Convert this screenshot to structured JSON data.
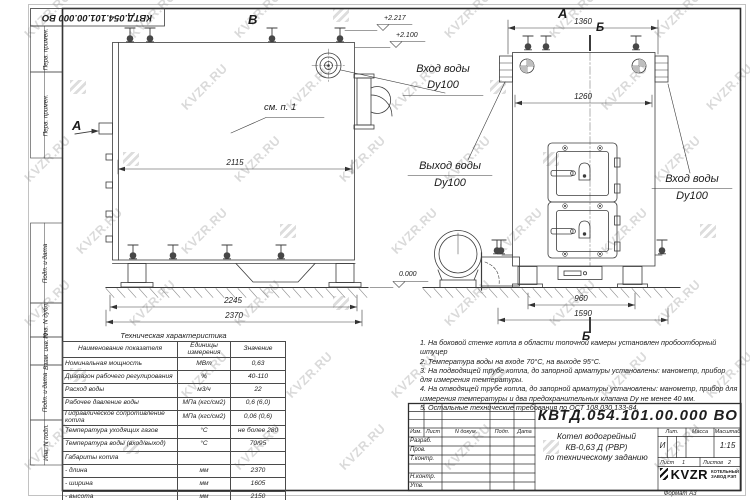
{
  "sheet": {
    "stamp_doc_number": "КВТД.054.101.00.000 ВО",
    "watermark_text": "KVZR.RU",
    "format_note": "Формат А3"
  },
  "margin_strips": [
    {
      "label": "Перв. примен."
    },
    {
      "label": "Перв. примен."
    },
    {
      "label": "Подп. и дата"
    },
    {
      "label": "Инв. N дубл."
    },
    {
      "label": "Взам. инв. N"
    },
    {
      "label": "Подп. и дата"
    },
    {
      "label": "Инв. N подл."
    }
  ],
  "views": {
    "left": {
      "view_label": "В",
      "direction_arrow_label": "А",
      "see_note_label": "см. п. 1",
      "elevation_top": "+2.217",
      "elevation_mid": "+2.100",
      "elevation_zero": "0.000",
      "dim_length_inner": "2115",
      "dim_length_mid": "2245",
      "dim_length_total": "2370",
      "inlet_line1": "Вход воды",
      "inlet_line2": "Dy100",
      "outlet_line1": "Выход воды",
      "outlet_line2": "Dy100"
    },
    "right": {
      "view_label": "А",
      "section_label_top": "Б",
      "section_label_bottom": "Б",
      "dim_width_top": "1360",
      "dim_width_inner": "1260",
      "dim_base_inner": "960",
      "dim_base_total": "1590",
      "inlet_line1": "Вход воды",
      "inlet_line2": "Dy100"
    }
  },
  "notes": [
    "1. На боковой стенке котла в области топочной камеры установлен пробоотборный штуцер",
    "2. Температура воды на входе 70°С, на выходе 95°С.",
    "3. На подводящей трубе котла, до запорной арматуры установлены: манометр, прибор для измерения температуры.",
    "4. На отводящей трубе котла, до запорной арматуры установлены: манометр, прибор для измерения температуры и два предохранительных клапана Dу не менее 40 мм.",
    "5. Остальные технические требования по ОСТ 108.030.133-84."
  ],
  "spec_table": {
    "title": "Техническая характеристика",
    "headers": [
      "Наименование показателя",
      "Единицы измерения",
      "Значение"
    ],
    "rows": [
      [
        "Номинальная мощность",
        "МВт",
        "0,63"
      ],
      [
        "Диапазон рабочего регулирования",
        "%",
        "40-110"
      ],
      [
        "Расход воды",
        "м3/ч",
        "22"
      ],
      [
        "Рабочее давление воды",
        "МПа (кгс/см2)",
        "0,6 (6,0)"
      ],
      [
        "Гидравлическое сопротивление котла",
        "МПа (кгс/см2)",
        "0,06 (0,6)"
      ],
      [
        "Температура уходящих газов",
        "°С",
        "не более 280"
      ],
      [
        "Температура воды (вход/выход)",
        "°С",
        "70/95"
      ],
      [
        "Габариты котла",
        "",
        ""
      ],
      [
        "- длина",
        "мм",
        "2370"
      ],
      [
        "- ширина",
        "мм",
        "1605"
      ],
      [
        "- высота",
        "мм",
        "2150"
      ]
    ]
  },
  "title_block": {
    "doc_number": "КВТД.054.101.00.000 ВО",
    "change_headers": [
      "Изм.",
      "Лист",
      "N докум.",
      "Подп.",
      "Дата"
    ],
    "signature_rows": [
      "Разраб.",
      "Пров.",
      "Т.контр.",
      "",
      "Н.контр.",
      "Утв."
    ],
    "product_line1": "Котел водогрейный",
    "product_line2": "КВ-0,63 Д (РВР)",
    "product_line3": "по техническому заданию",
    "lit_header": "Лит.",
    "mass_header": "Масса",
    "scale_header": "Масштаб",
    "lit_value": "И",
    "scale_value": "1:15",
    "sheet_label": "Лист",
    "sheet_number": "1",
    "sheets_label": "Листов",
    "sheets_total": "2",
    "logo_text": "KVZR",
    "logo_caption_line1": "КОТЕЛЬНЫЙ",
    "logo_caption_line2": "ЗАВОД РЭП"
  }
}
